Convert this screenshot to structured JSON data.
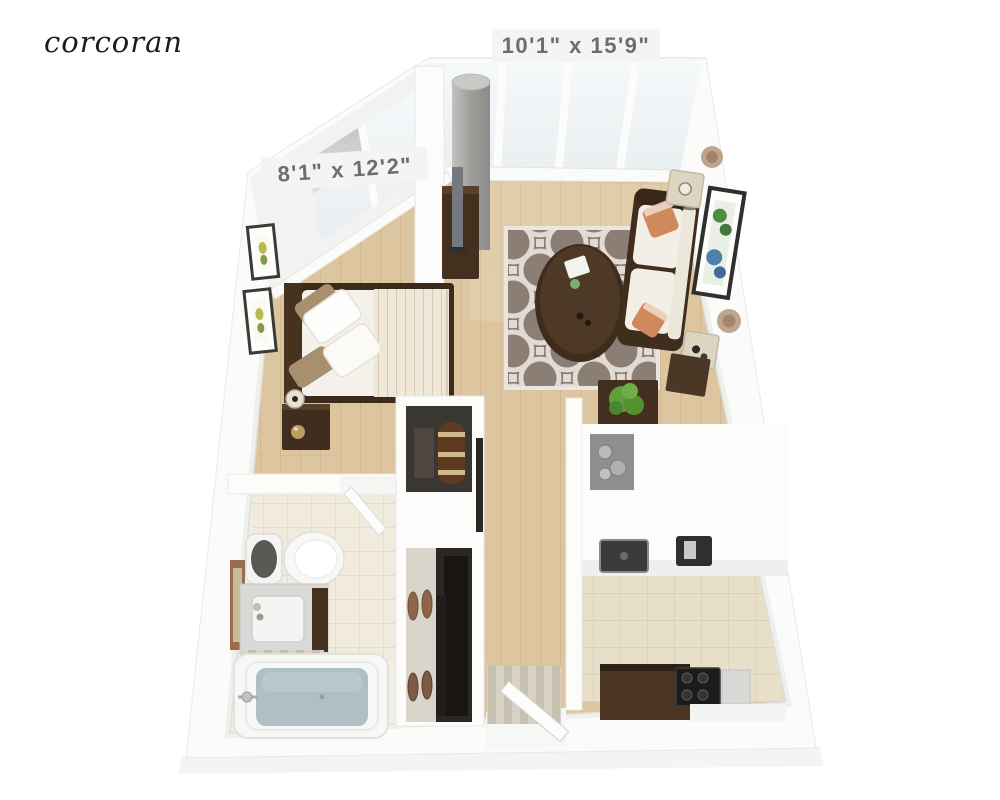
{
  "brand": {
    "logo_text": "corcoran",
    "logo_color": "#1c1c1a"
  },
  "dimension_labels": {
    "living_room": "10'1\" x 15'9\"",
    "bedroom": "8'1\" x 12'2\"",
    "text_color": "#6d6d6d",
    "chip_color": "#f4f4f3"
  },
  "palette": {
    "background": "#ffffff",
    "wall": "#fbfbfa",
    "wall_shade": "#efefed",
    "wood_floor": "#ddc69f",
    "wood_line": "#c9ae83",
    "tile_kitchen": "#e8dfc9",
    "tile_bath": "#f0ebdd",
    "rug_base": "#8b7f75",
    "rug_pattern": "#eae5de",
    "dark_wood": "#44301e",
    "espresso": "#35261a",
    "upholstery": "#f3efe6",
    "accent_pillow": "#d0895c",
    "tub_water": "#aebfc6",
    "plant_green": "#5f9e3c",
    "glass": "#f1f5f6",
    "concrete": "#a9a9a6",
    "closet_dark": "#2b2724",
    "shoe_brown": "#8f654a",
    "gold": "#bd9d5f",
    "art_green": "#4e8c45",
    "art_blue": "#4d80ab",
    "medallion": "#b29779"
  }
}
